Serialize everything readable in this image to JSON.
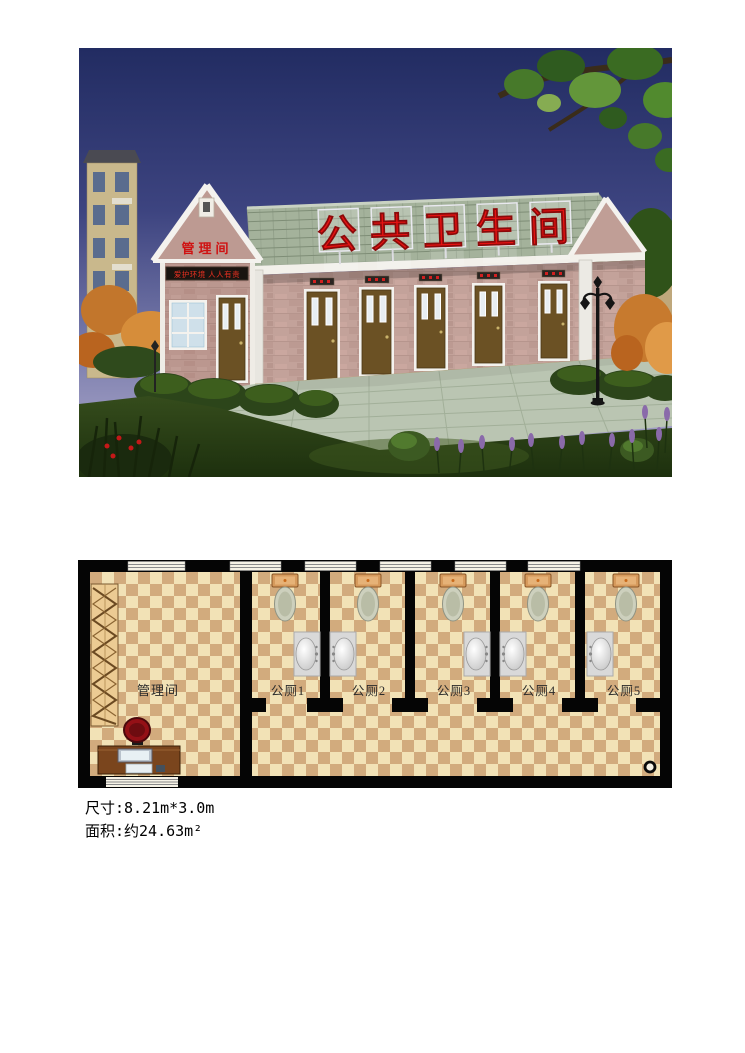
{
  "rendering": {
    "roof_sign": "公共卫生间",
    "gable_sign": "管理间",
    "led_text": "爱护环境 人人有责"
  },
  "plan": {
    "rooms": [
      {
        "label": "管理间"
      },
      {
        "label": "公厕1"
      },
      {
        "label": "公厕2"
      },
      {
        "label": "公厕3"
      },
      {
        "label": "公厕4"
      },
      {
        "label": "公厕5"
      }
    ]
  },
  "specs": {
    "size_line": "尺寸:8.21m*3.0m",
    "area_line": "面积:约24.63m²"
  },
  "colors": {
    "sign_red": "#e61212",
    "roof_green": "#a4b29b",
    "wall_pink": "#c3a29a",
    "door_brown": "#6b5124",
    "sky_top": "#222c62",
    "sky_bottom": "#b5b0d0",
    "floor_light": "#f2e2b6",
    "floor_dark": "#d2ab7d",
    "wall_line": "#050505"
  },
  "icons": {
    "toilet": "toilet-icon",
    "sink": "sink-icon",
    "drain": "floor-drain-icon",
    "desk": "office-desk-icon",
    "chair": "office-chair-icon",
    "shelf": "shelf-icon",
    "lamp": "street-lamp-icon"
  }
}
